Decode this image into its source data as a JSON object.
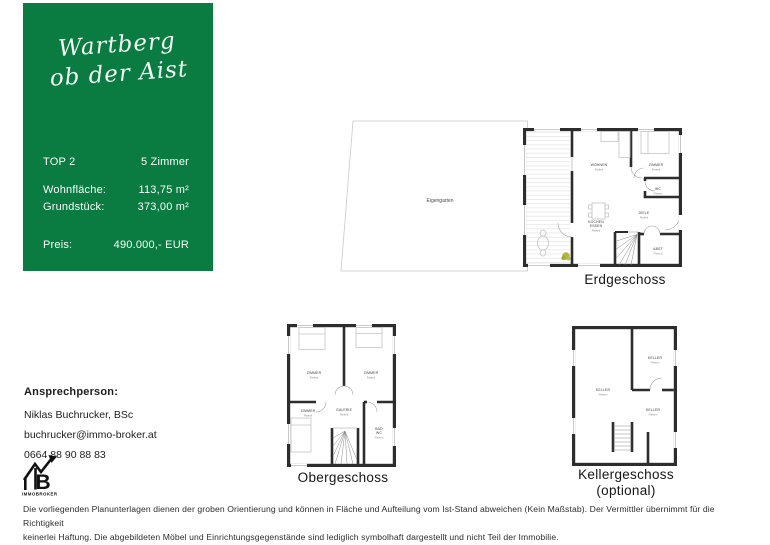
{
  "panel": {
    "headline_line1": "Wartberg",
    "headline_line2": "ob der Aist",
    "unit_label": "TOP 2",
    "rooms_count": "5 Zimmer",
    "living_label": "Wohnfläche:",
    "living_value": "113,75 m²",
    "plot_label": "Grundstück:",
    "plot_value": "373,00 m²",
    "price_label": "Preis:",
    "price_value": "490.000,- EUR",
    "bg_color": "#0a7b41"
  },
  "contact": {
    "heading": "Ansprechperson:",
    "name": "Niklas Buchrucker, BSc",
    "email": "buchrucker@immo-broker.at",
    "phone": "0664 88 90 88 83"
  },
  "logo": {
    "brand": "IMMOBROKER",
    "monogram": "B"
  },
  "plans": {
    "erdgeschoss": {
      "caption": "Erdgeschoss",
      "garden_label": "Eigengarten",
      "rooms": [
        {
          "name": "WOHNEN",
          "floor": "Parkett"
        },
        {
          "name": "ZIMMER",
          "floor": "Parkett"
        },
        {
          "name": "WC",
          "floor": "Fliesen"
        },
        {
          "name": "DIELE",
          "floor": "Parkett"
        },
        {
          "name": "KOCHEN",
          "name2": "ESSEN",
          "floor": "Parkett"
        },
        {
          "name": "ABST",
          "floor": "Fliesen"
        }
      ]
    },
    "obergeschoss": {
      "caption": "Obergeschoss",
      "rooms": [
        {
          "name": "ZIMMER",
          "floor": "Parkett"
        },
        {
          "name": "ZIMMER",
          "floor": "Parkett"
        },
        {
          "name": "ZIMMER",
          "floor": "Parkett"
        },
        {
          "name": "GALERIE",
          "floor": "Parkett"
        },
        {
          "name": "BAD",
          "name2": "WC",
          "floor": "Fliesen"
        }
      ]
    },
    "kellergeschoss": {
      "caption_line1": "Kellergeschoss",
      "caption_line2": "(optional)",
      "rooms": [
        {
          "name": "KELLER",
          "floor": "Fliesen"
        },
        {
          "name": "KELLER",
          "floor": "Fliesen"
        },
        {
          "name": "KELLER",
          "floor": "Fliesen"
        }
      ]
    }
  },
  "disclaimer": {
    "line1": "Die vorliegenden Planunterlagen dienen der groben Orientierung und können in Fläche und Aufteilung vom Ist-Stand abweichen (Kein Maßstab). Der Vermittler übernimmt für die Richtigkeit",
    "line2": "keinerlei Haftung. Die abgebildeten Möbel und Einrichtungsgegenstände sind lediglich symbolhaft dargestellt und nicht Teil der Immobilie."
  },
  "colors": {
    "brand_green": "#0a7b41",
    "plant_olive": "#b2b440",
    "wall": "#2d2d2d"
  }
}
